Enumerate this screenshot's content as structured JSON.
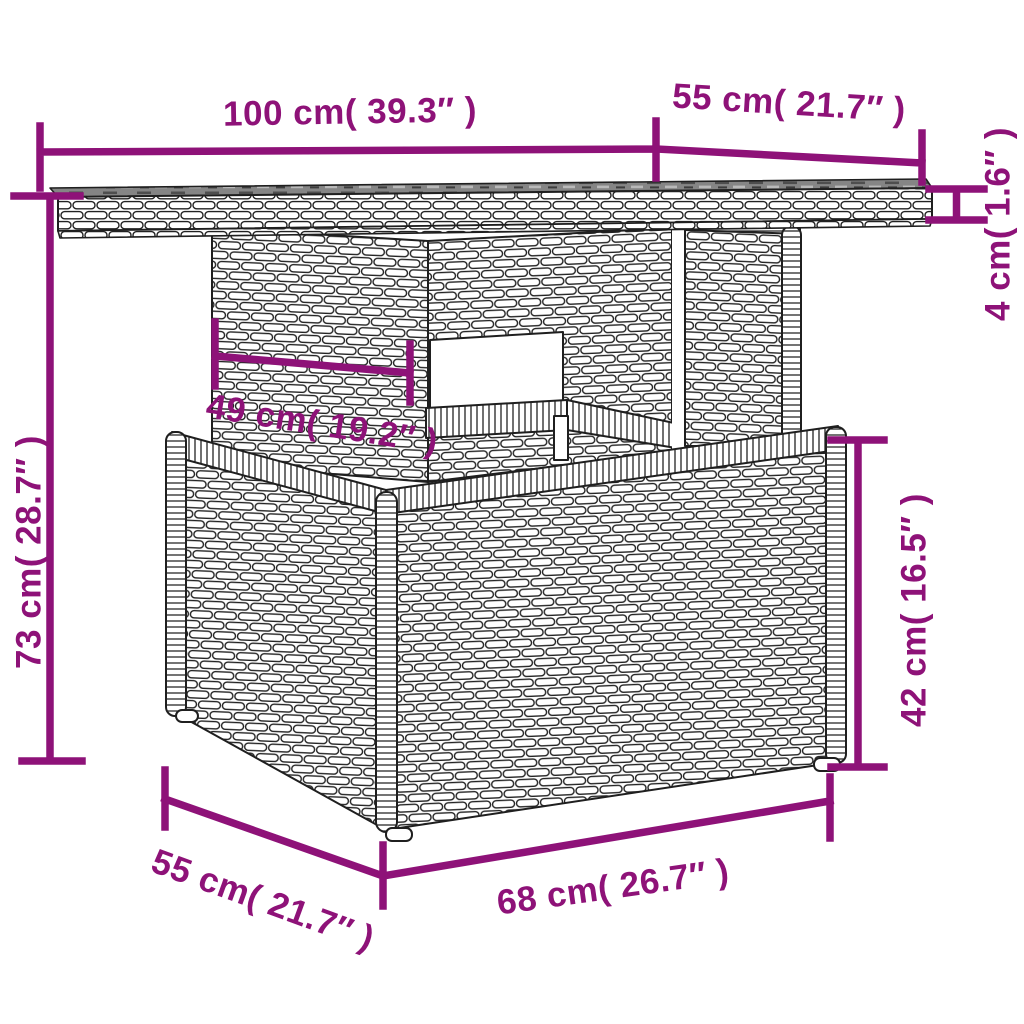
{
  "accent_color": "#8e1278",
  "ink_color": "#1f1f1f",
  "measurements": {
    "width_top": "100 cm( 39.3″ )",
    "depth_top": "55 cm( 21.7″ )",
    "top_thickness": "4 cm( 1.6″ )",
    "overall_height": "73 cm( 28.7″ )",
    "pedestal_width": "49 cm( 19.2″ )",
    "base_height": "42 cm( 16.5″ )",
    "base_depth": "55 cm( 21.7″ )",
    "base_width": "68 cm( 26.7″ )"
  }
}
